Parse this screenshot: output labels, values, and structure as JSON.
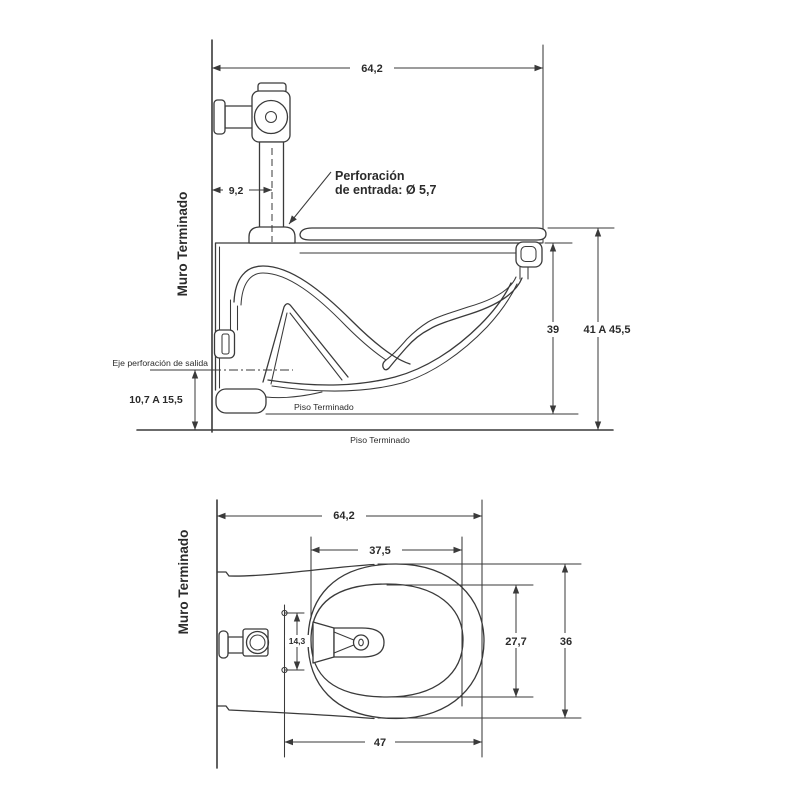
{
  "colors": {
    "line": "#3a3a3a",
    "text": "#2b2b2b",
    "background": "#ffffff"
  },
  "side_view": {
    "wall_label": "Muro Terminado",
    "floor_label": "Piso Terminado",
    "bowl_base_label": "Piso Terminado",
    "outlet_axis_label": "Eje perforación de salida",
    "inlet_note_line1": "Perforación",
    "inlet_note_line2": "de entrada: Ø 5,7",
    "dim_overall_depth": "64,2",
    "dim_inlet_offset": "9,2",
    "dim_bowl_height": "39",
    "dim_rim_height_range": "41 A 45,5",
    "dim_outlet_axis_height_range": "10,7 A 15,5"
  },
  "plan_view": {
    "wall_label": "Muro Terminado",
    "dim_overall_depth": "64,2",
    "dim_bowl_opening_depth": "37,5",
    "dim_bolt_spacing": "14,3",
    "dim_bowl_inner_width": "27,7",
    "dim_overall_width": "36",
    "dim_bolt_line_to_rear": "47"
  }
}
